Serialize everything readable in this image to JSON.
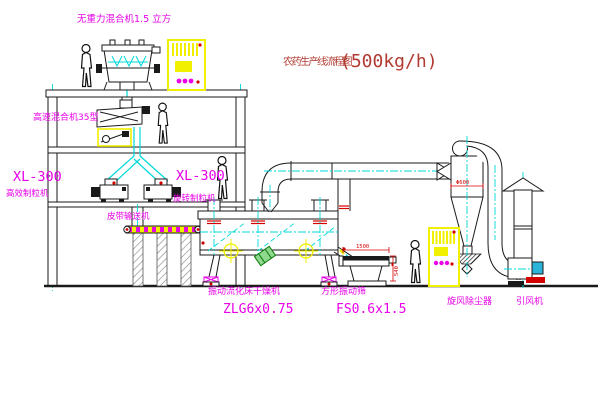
{
  "title": {
    "text_zh": "农药生产线流程图",
    "capacity": "(500kg/h)"
  },
  "equipment_labels": {
    "weightless_mixer": "无重力混合机1.5 立方",
    "high_speed_mixer": "高速混合机35型",
    "granulator_model_left": "XL-300",
    "granulator_name_left": "高效制粒机",
    "granulator_model_center": "XL-300",
    "granulator_name_center": "旋转制粒机",
    "belt_conveyor": "皮带输送机",
    "fluid_bed_dryer": "振动流化床干燥机",
    "fluid_bed_dryer_model": "ZLG6x0.75",
    "square_vibrating_sieve": "方形振动筛",
    "square_vibrating_sieve_model": "FS0.6x1.5",
    "cyclone_dust_collector": "旋风除尘器",
    "induced_draft_fan": "引风机"
  },
  "dimensions": {
    "sieve_length": "1500",
    "sieve_height": "540",
    "cyclone_diameter": "Φ600"
  },
  "colors": {
    "line": "#1a1a1a",
    "centerline_cyan": "#00d8d8",
    "label_magenta": "#e800e8",
    "cabinet_yellow": "#f0f000",
    "dimension_red": "#d40000",
    "title_red": "#b13a30",
    "motor_green": "#57c84d",
    "motor_blue": "#2bb3d9"
  }
}
